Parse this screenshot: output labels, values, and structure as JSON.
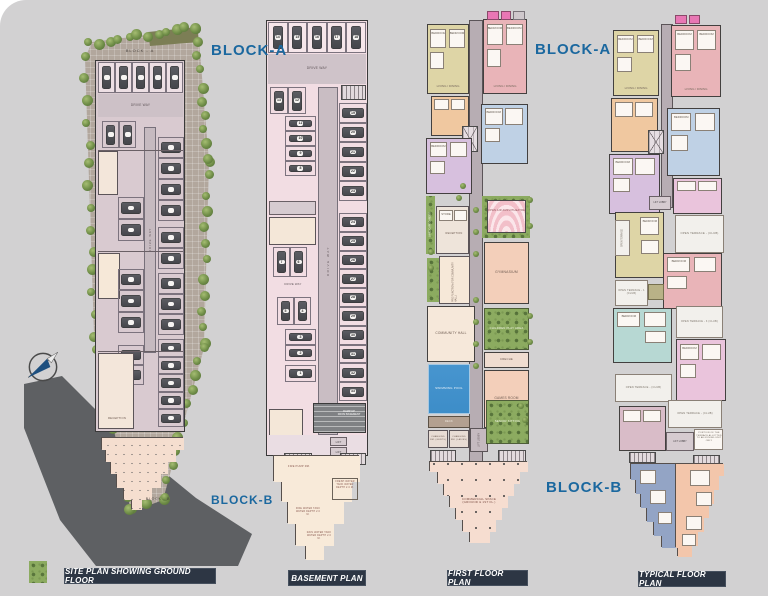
{
  "ui": {
    "captions": {
      "site": "SITE PLAN SHOWING GROUND FLOOR",
      "basement": "BASEMENT PLAN",
      "first": "FIRST FLOOR PLAN",
      "typical": "TYPICAL FLOOR PLAN"
    },
    "block_a": "BLOCK-A",
    "block_b": "BLOCK-B"
  },
  "site": {
    "block_a_small": "BLOCK - A",
    "block_b_small": "BLOCK - B",
    "drive_way": "DRIVE WAY",
    "reception": "RECEPTION"
  },
  "basement": {
    "drive_way": "DRIVE WAY",
    "lift": "LIFT",
    "ramp_line1": "RAMP UP",
    "ramp_line2": "FROM BASEMENT",
    "stalls": {
      "top": [
        "14",
        "15",
        "16",
        "17",
        "18"
      ],
      "pair_a": [
        "13",
        "12"
      ],
      "col_a": [
        "11",
        "10",
        "9",
        "8"
      ],
      "col_b": [
        "19",
        "20",
        "21",
        "22",
        "23"
      ],
      "pair_c": [
        "7",
        "6"
      ],
      "pair_d": [
        "5",
        "4"
      ],
      "col_e": [
        "3",
        "2"
      ],
      "col_f": [
        "1"
      ],
      "col_g": [
        "24",
        "25",
        "26",
        "27",
        "28",
        "29",
        "30",
        "31",
        "32",
        "33"
      ]
    },
    "tanks": {
      "fire_pump": "FIRE PUMP RM.",
      "fresh": "FRESH WATER TANK WATER DEPTH 2.0 M.",
      "fire": "FIRE WATER TANK WATER DEPTH 2.0 M.",
      "rain": "RAIN WATER TANK WATER DEPTH 2.0 M."
    }
  },
  "first": {
    "amphitheatre": "OPEN AIR AMPHITHEATRE",
    "gymnasium": "GYMNASIUM",
    "children_play": "CHILDREN PLAY AREA",
    "creche": "CRECHE",
    "games_room": "GAMES ROOM",
    "community_hall": "COMMUNITY HALL",
    "pre_function": "PRE FUNCTION (FOR COMMUNITY HALL)",
    "swimming_pool": "SWIMMING POOL",
    "senior_sitting": "SENIOR SITTING",
    "deck": "DECK",
    "changing_gents": "CHANGING RM. (GENTS)",
    "changing_ladies": "CHANGING RM. (LADIES)",
    "lift_lobby": "LIFT LOBBY",
    "landscape_garden": "LANDSCAPE GARDEN",
    "reception": "RECEPTION",
    "store": "STORE",
    "commercial_line1": "COMMERCIAL SPACE",
    "commercial_line2": "(GROUND & 1ST FL.)"
  },
  "typical": {
    "lift_lobby": "LIFT LOBBY",
    "open_terrace": "OPEN TERRACE",
    "open_terrace_club": "OPEN TERRACE - (CLUB)",
    "open_terrace_1": "OPEN TERRACE - 1 (CLUB)",
    "open_terrace_3": "OPEN TERRACE - 3 (CLUB)",
    "terrace_note": "PORTION OF THE TERRACE ALLOTTED TO ADJOINING UNIT ONLY"
  },
  "shared": {
    "bedroom": "BEDROOM",
    "living": "LIVING / DINING",
    "kitchen": "KIT.",
    "toilet": "TOIL."
  },
  "colors": {
    "accent_blue": "#1b689f",
    "caption_bg": "#2d3644",
    "pool_blue": "#3d8dc8",
    "landscape_green": "#8cab60",
    "road_gray": "#5e6063"
  }
}
